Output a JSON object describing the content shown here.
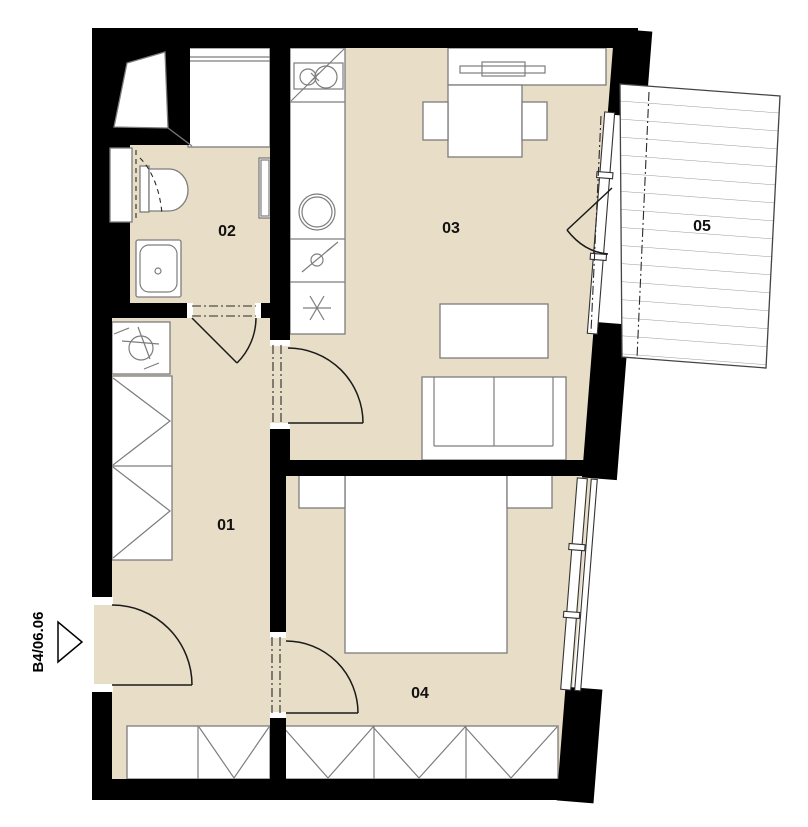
{
  "plan": {
    "unit_label": "B4/06.06",
    "rooms": [
      {
        "number": "01"
      },
      {
        "number": "02"
      },
      {
        "number": "03"
      },
      {
        "number": "04"
      },
      {
        "number": "05"
      }
    ]
  },
  "colors": {
    "background": "#ffffff",
    "floor_fill": "#e8ddc6",
    "wall_fill": "#000000",
    "furniture_line": "#7d7d7d",
    "label_text": "#111111",
    "balcony_board_line": "#9a9a9a"
  },
  "icons": [
    "entry-direction-triangle-icon",
    "washing-machine-icon",
    "wardrobe-chevron-icon",
    "cooktop-icon",
    "round-sink-icon",
    "dishwasher-icon",
    "fridge-snowflake-icon",
    "toilet-icon",
    "washbasin-icon",
    "shower-icon",
    "towel-radiator-icon",
    "balcony-decking-hatch"
  ]
}
